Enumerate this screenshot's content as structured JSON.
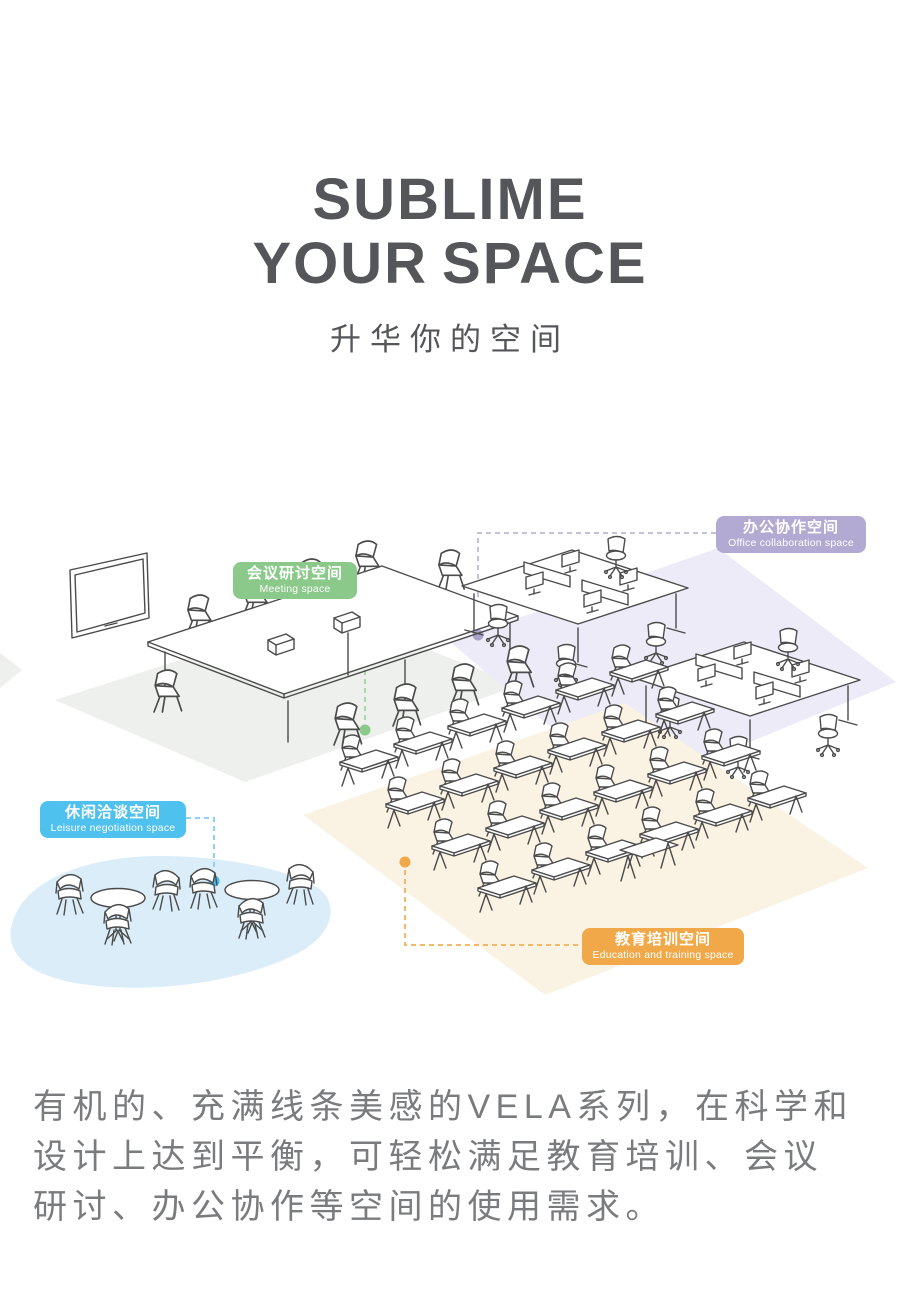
{
  "header": {
    "title_line1": "SUBLIME",
    "title_line2_a": "YOUR",
    "title_line2_b": "SPACE",
    "subtitle": "升华你的空间",
    "title_color": "#55565a"
  },
  "zones": [
    {
      "id": "meeting",
      "label_zh": "会议研讨空间",
      "label_en": "Meeting space",
      "color": "#8bc98b",
      "dash_color": "#a8d6a8",
      "dot_color": "#8bc98b",
      "floor_color": "#edf0ec"
    },
    {
      "id": "office",
      "label_zh": "办公协作空间",
      "label_en": "Office collaboration space",
      "color": "#b3aad3",
      "dash_color": "#c5c0dd",
      "dot_color": "#a9a3c9",
      "floor_color": "#ecebf7"
    },
    {
      "id": "leisure",
      "label_zh": "休闲洽谈空间",
      "label_en": "Leisure negotiation space",
      "color": "#4fc1ee",
      "dash_color": "#8ed4f2",
      "dot_color": "#3fbcee",
      "floor_color": "#daedf9"
    },
    {
      "id": "education",
      "label_zh": "教育培训空间",
      "label_en": "Education and training space",
      "color": "#f0a848",
      "dash_color": "#f3b96a",
      "dot_color": "#f0a848",
      "floor_color": "#faf2e2"
    }
  ],
  "description": {
    "line1": "有机的、充满线条美感的VELA系列，在科学和",
    "line2": "设计上达到平衡，可轻松满足教育培训、会议",
    "line3": "研讨、办公协作等空间的使用需求。",
    "full_text": "有机的、充满线条美感的VELA系列，在科学和设计上达到平衡，可轻松满足教育培训、会议研讨、办公协作等空间的使用需求。"
  }
}
